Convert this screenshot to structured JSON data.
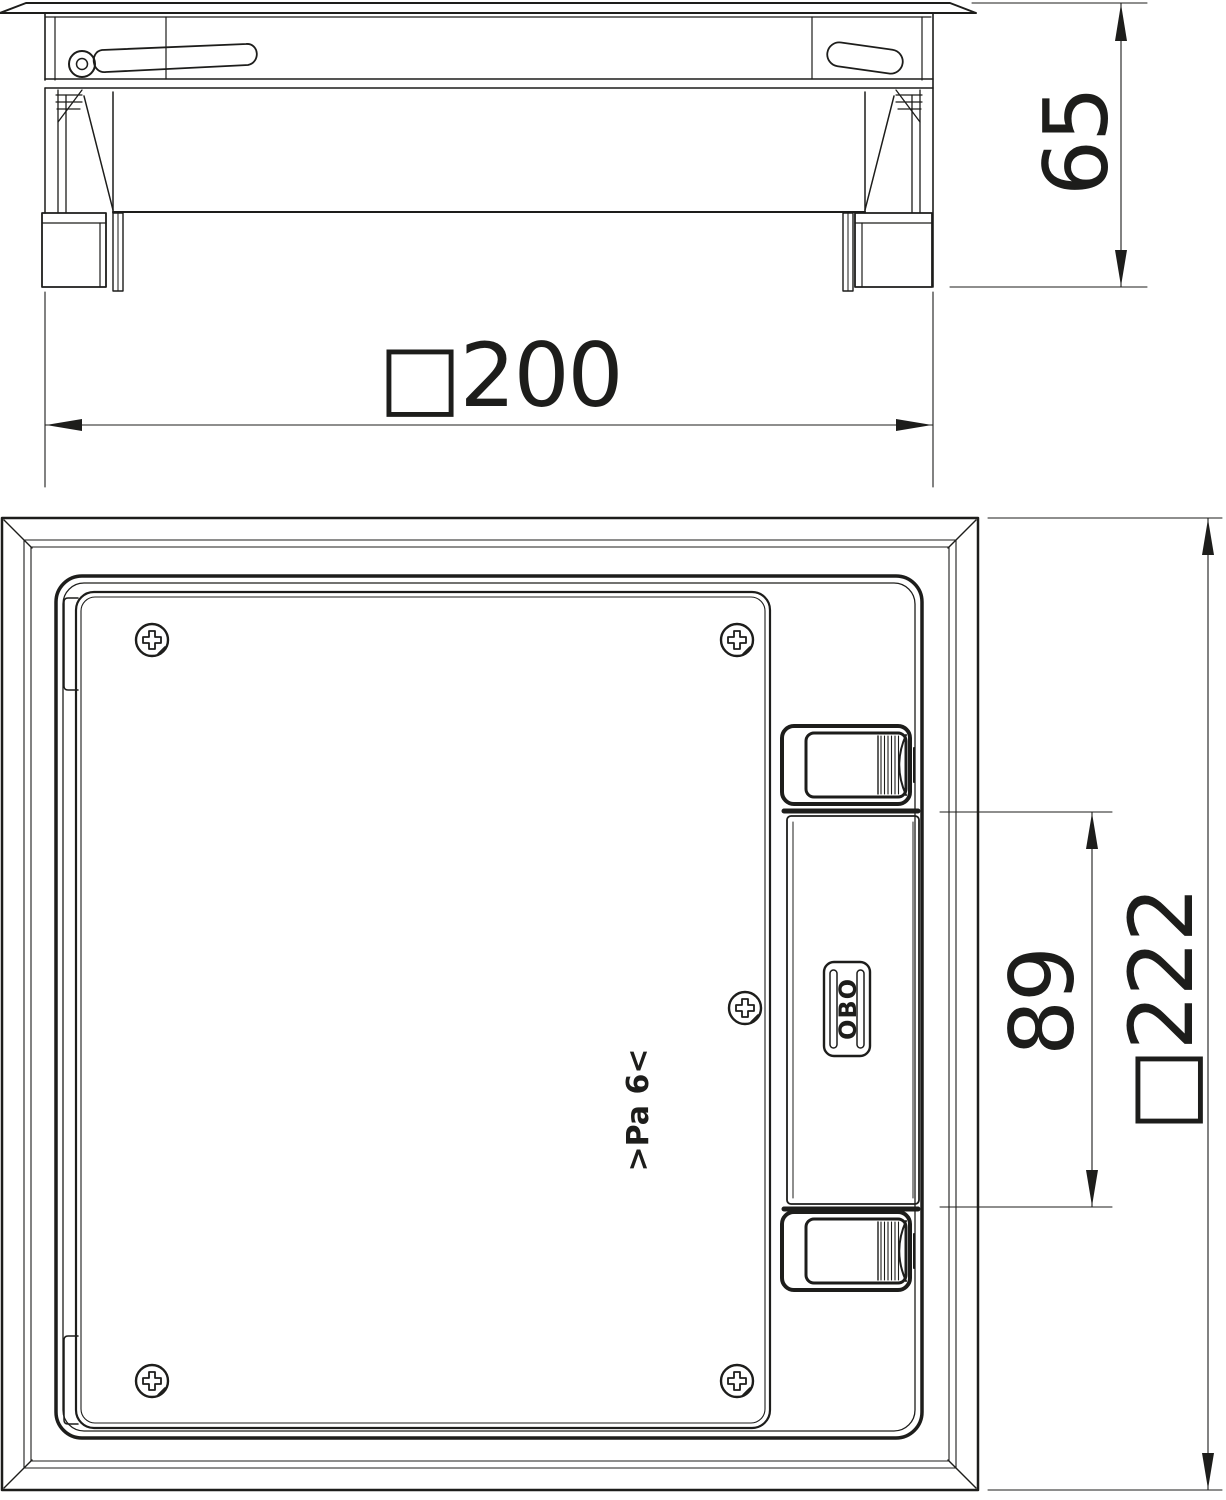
{
  "labels": {
    "top_width": "□200",
    "side_height": "65",
    "plan_outer": "□222",
    "plan_latch_spacing": "89",
    "logo": "OBO",
    "material_mark": ">Pa 6<"
  },
  "colors": {
    "line": "#1d1d1b",
    "background": "#ffffff"
  },
  "views": {
    "side_view": "side-elevation-of-floor-box",
    "plan_view": "top-plan-of-floor-box-cassette"
  }
}
